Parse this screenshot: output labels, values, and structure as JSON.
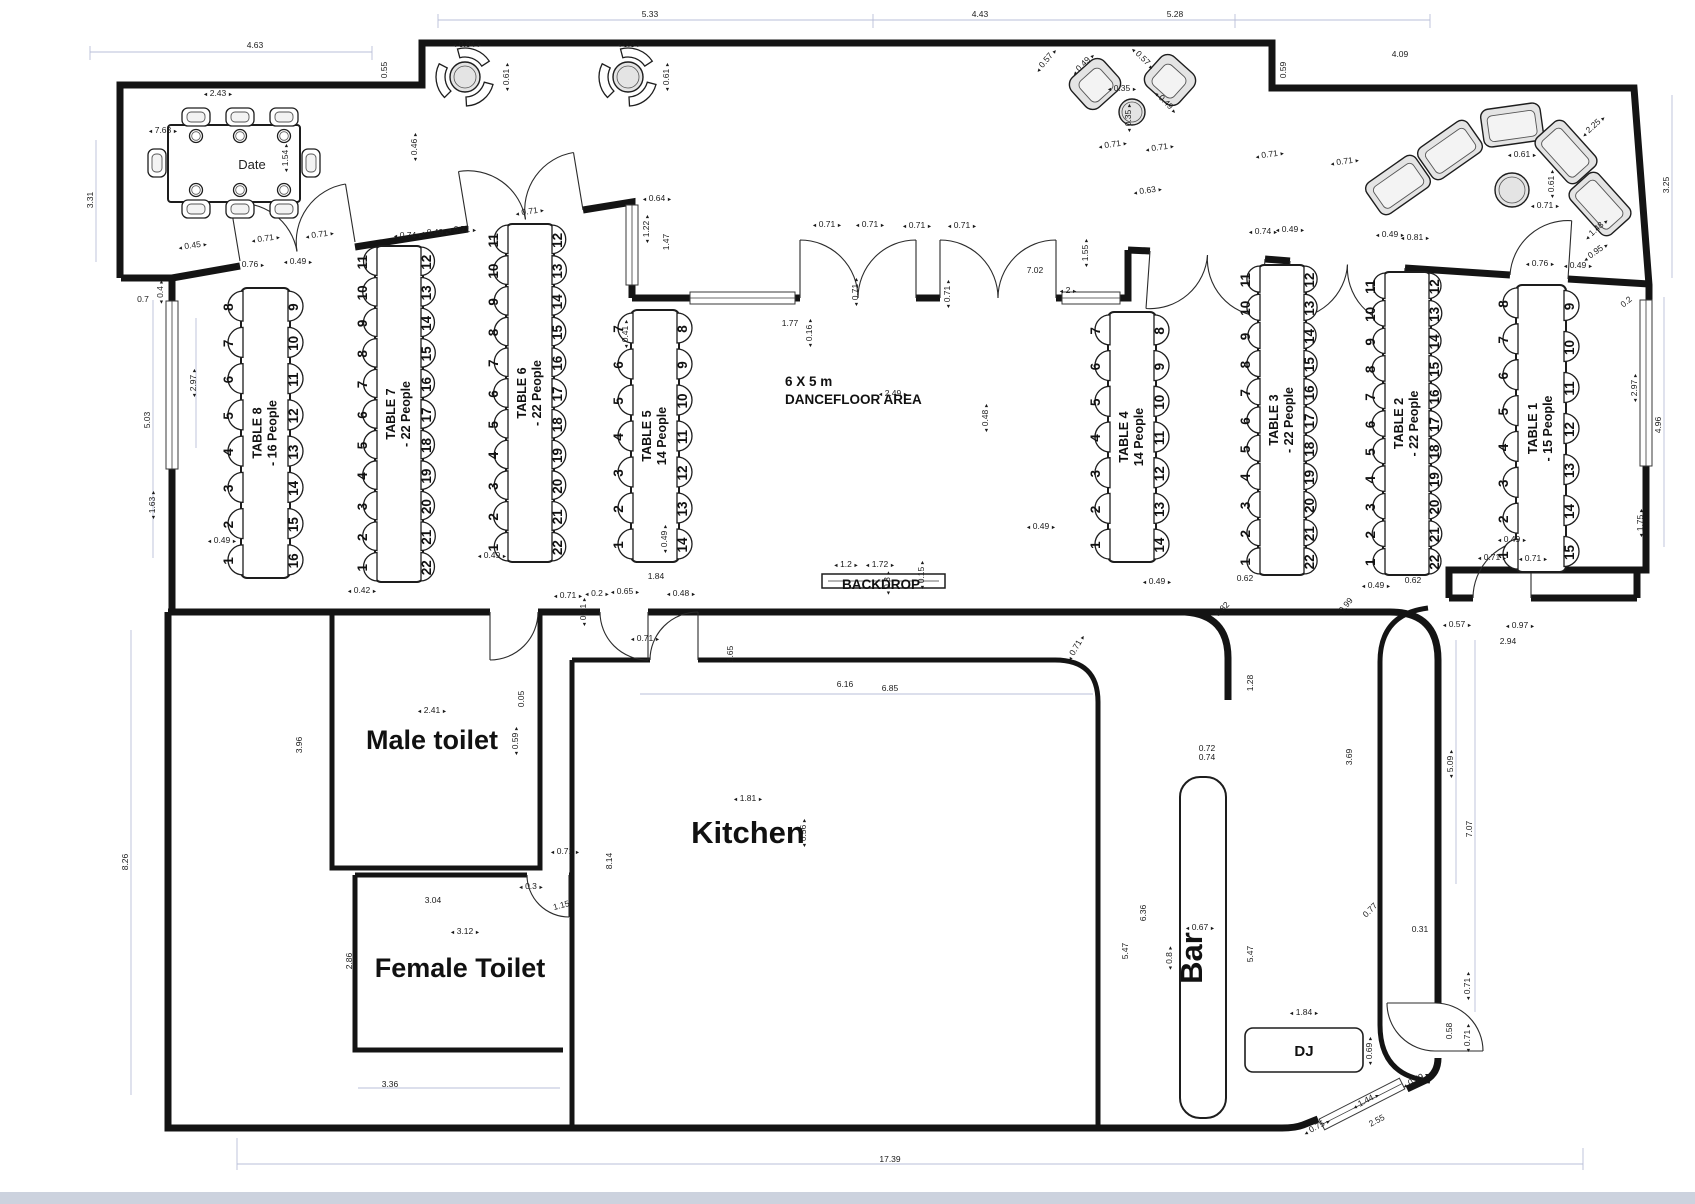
{
  "rooms": {
    "male_toilet": "Male toilet",
    "female_toilet": "Female Toilet",
    "kitchen": "Kitchen",
    "bar": "Bar",
    "dj": "DJ",
    "dancefloor_size": "6 X 5 m",
    "dancefloor_name": "DANCEFLOOR AREA",
    "backdrop": "BACKDROP",
    "head_table": "Date"
  },
  "tables": [
    {
      "name": "TABLE 1",
      "people": "- 15 People",
      "x": 1516,
      "y": 285,
      "w": 50,
      "h": 287,
      "left": [
        8,
        7,
        6,
        5,
        4,
        3,
        2,
        1
      ],
      "right": [
        9,
        10,
        11,
        12,
        13,
        14,
        15
      ]
    },
    {
      "name": "TABLE 2",
      "people": "- 22 People",
      "x": 1383,
      "y": 272,
      "w": 48,
      "h": 303,
      "left": [
        11,
        10,
        9,
        8,
        7,
        6,
        5,
        4,
        3,
        2,
        1
      ],
      "right": [
        12,
        13,
        14,
        15,
        16,
        17,
        18,
        19,
        20,
        21,
        22
      ]
    },
    {
      "name": "TABLE 3",
      "people": "- 22 People",
      "x": 1258,
      "y": 265,
      "w": 48,
      "h": 310,
      "left": [
        11,
        10,
        9,
        8,
        7,
        6,
        5,
        4,
        3,
        2,
        1
      ],
      "right": [
        12,
        13,
        14,
        15,
        16,
        17,
        18,
        19,
        20,
        21,
        22
      ]
    },
    {
      "name": "TABLE 4",
      "people": "14 People",
      "x": 1108,
      "y": 312,
      "w": 48,
      "h": 250,
      "left": [
        7,
        6,
        5,
        4,
        3,
        2,
        1
      ],
      "right": [
        8,
        9,
        10,
        11,
        12,
        13,
        14
      ]
    },
    {
      "name": "TABLE 5",
      "people": "14 People",
      "x": 631,
      "y": 310,
      "w": 48,
      "h": 252,
      "left": [
        7,
        6,
        5,
        4,
        3,
        2,
        1
      ],
      "right": [
        8,
        9,
        10,
        11,
        12,
        13,
        14
      ]
    },
    {
      "name": "TABLE 6",
      "people": "- 22 People",
      "x": 506,
      "y": 224,
      "w": 48,
      "h": 338,
      "left": [
        11,
        10,
        9,
        8,
        7,
        6,
        5,
        4,
        3,
        2,
        1
      ],
      "right": [
        12,
        13,
        14,
        15,
        16,
        17,
        18,
        19,
        20,
        21,
        22
      ]
    },
    {
      "name": "TABLE 7",
      "people": "- 22 People",
      "x": 375,
      "y": 246,
      "w": 48,
      "h": 336,
      "left": [
        11,
        10,
        9,
        8,
        7,
        6,
        5,
        4,
        3,
        2,
        1
      ],
      "right": [
        12,
        13,
        14,
        15,
        16,
        17,
        18,
        19,
        20,
        21,
        22
      ]
    },
    {
      "name": "TABLE 8",
      "people": "- 16 People",
      "x": 241,
      "y": 288,
      "w": 49,
      "h": 290,
      "left": [
        8,
        7,
        6,
        5,
        4,
        3,
        2,
        1
      ],
      "right": [
        9,
        10,
        11,
        12,
        13,
        14,
        15,
        16
      ]
    }
  ],
  "dims": [
    [
      "5.33",
      650,
      17,
      0,
      0
    ],
    [
      "4.43",
      980,
      17,
      0,
      0
    ],
    [
      "5.28",
      1175,
      17,
      0,
      0
    ],
    [
      "4.63",
      255,
      48,
      0,
      0
    ],
    [
      "0.55",
      387,
      70,
      -90,
      0
    ],
    [
      "0.84",
      467,
      47,
      0,
      1
    ],
    [
      "0.61",
      509,
      77,
      -90,
      1
    ],
    [
      "0.8",
      629,
      47,
      0,
      1
    ],
    [
      "0.61",
      669,
      77,
      -90,
      1
    ],
    [
      "0.57",
      1048,
      62,
      -50,
      1
    ],
    [
      "0.49",
      1085,
      66,
      -45,
      1
    ],
    [
      "0.35",
      1122,
      91,
      0,
      1
    ],
    [
      "0.35",
      1131,
      118,
      -90,
      1
    ],
    [
      "0.57",
      1141,
      60,
      45,
      1
    ],
    [
      "0.49",
      1164,
      104,
      45,
      1
    ],
    [
      "4.09",
      1400,
      57,
      0,
      0
    ],
    [
      "0.59",
      1286,
      70,
      -90,
      0
    ],
    [
      "2.25",
      1595,
      128,
      -42,
      1
    ],
    [
      "0.61",
      1522,
      157,
      0,
      1
    ],
    [
      "0.61",
      1554,
      184,
      -90,
      1
    ],
    [
      "0.71",
      1545,
      208,
      0,
      1
    ],
    [
      "1.48",
      1598,
      231,
      -42,
      1
    ],
    [
      "0.95",
      1597,
      254,
      -35,
      1
    ],
    [
      "3.25",
      1669,
      185,
      -90,
      0
    ],
    [
      "0.2",
      1628,
      304,
      -40,
      0
    ],
    [
      "2.97",
      1637,
      388,
      -90,
      1
    ],
    [
      "4.96",
      1661,
      425,
      -90,
      0
    ],
    [
      "1.75",
      1643,
      523,
      -90,
      1
    ],
    [
      "3.31",
      93,
      200,
      -90,
      0
    ],
    [
      "7.63",
      163,
      133,
      0,
      1
    ],
    [
      "2.43",
      218,
      96,
      0,
      1
    ],
    [
      "1.54",
      288,
      158,
      -90,
      1
    ],
    [
      "0.46",
      417,
      147,
      -90,
      1
    ],
    [
      "0.4",
      163,
      292,
      -90,
      1
    ],
    [
      "0.7",
      143,
      302,
      0,
      0
    ],
    [
      "5.03",
      150,
      420,
      -90,
      0
    ],
    [
      "2.97",
      196,
      383,
      -90,
      1
    ],
    [
      "1.63",
      155,
      505,
      -90,
      1
    ],
    [
      "8.26",
      128,
      862,
      -90,
      0
    ],
    [
      "0.45",
      193,
      248,
      -8,
      1
    ],
    [
      "0.71",
      266,
      241,
      -8,
      1
    ],
    [
      "0.71",
      320,
      237,
      -8,
      1
    ],
    [
      "0.76",
      250,
      267,
      0,
      1
    ],
    [
      "0.49",
      298,
      264,
      0,
      1
    ],
    [
      "0.74",
      408,
      238,
      0,
      1
    ],
    [
      "0.49",
      435,
      235,
      0,
      1
    ],
    [
      "0.71",
      462,
      232,
      0,
      1
    ],
    [
      "0.71",
      530,
      214,
      -8,
      1
    ],
    [
      "0.64",
      657,
      201,
      0,
      1
    ],
    [
      "1.22",
      649,
      229,
      -90,
      1
    ],
    [
      "1.47",
      669,
      242,
      -90,
      0
    ],
    [
      "0.41",
      628,
      334,
      -90,
      1
    ],
    [
      "1.77",
      790,
      326,
      0,
      0
    ],
    [
      "0.16",
      812,
      333,
      -90,
      1
    ],
    [
      "0.71",
      827,
      227,
      0,
      1
    ],
    [
      "0.71",
      870,
      227,
      0,
      1
    ],
    [
      "0.71",
      917,
      228,
      0,
      1
    ],
    [
      "0.71",
      962,
      228,
      0,
      1
    ],
    [
      "0.71",
      858,
      292,
      -90,
      1
    ],
    [
      "0.71",
      950,
      294,
      -90,
      1
    ],
    [
      "7.02",
      1035,
      273,
      0,
      0
    ],
    [
      "2",
      1068,
      293,
      0,
      1
    ],
    [
      "1.55",
      1088,
      253,
      -90,
      1
    ],
    [
      "0.63",
      1148,
      193,
      -8,
      1
    ],
    [
      "0.71",
      1113,
      147,
      -8,
      1
    ],
    [
      "0.71",
      1160,
      150,
      -8,
      1
    ],
    [
      "0.71",
      1270,
      157,
      -8,
      1
    ],
    [
      "0.71",
      1345,
      164,
      -8,
      1
    ],
    [
      "0.74",
      1263,
      234,
      0,
      1
    ],
    [
      "0.49",
      1290,
      232,
      0,
      1
    ],
    [
      "0.49",
      1390,
      237,
      0,
      1
    ],
    [
      "0.81",
      1415,
      240,
      0,
      1
    ],
    [
      "0.76",
      1540,
      266,
      0,
      1
    ],
    [
      "0.49",
      1578,
      268,
      0,
      1
    ],
    [
      "2.49",
      893,
      396,
      0,
      1
    ],
    [
      "0.48",
      988,
      418,
      -90,
      1
    ],
    [
      "1.2",
      846,
      567,
      0,
      1
    ],
    [
      "1.72",
      880,
      567,
      0,
      1
    ],
    [
      "0.15",
      924,
      575,
      -90,
      1
    ],
    [
      "0.3",
      890,
      583,
      -90,
      1
    ],
    [
      "0.49",
      222,
      543,
      0,
      1
    ],
    [
      "0.42",
      362,
      593,
      0,
      1
    ],
    [
      "1.84",
      656,
      579,
      0,
      0
    ],
    [
      "0.49",
      492,
      558,
      0,
      1
    ],
    [
      "0.49",
      667,
      539,
      -90,
      1
    ],
    [
      "0.71",
      568,
      598,
      0,
      1
    ],
    [
      "0.2",
      597,
      596,
      0,
      1
    ],
    [
      "0.65",
      625,
      594,
      0,
      1
    ],
    [
      "0.48",
      681,
      596,
      0,
      1
    ],
    [
      "0.71",
      586,
      612,
      -90,
      1
    ],
    [
      "0.49",
      1041,
      529,
      0,
      1
    ],
    [
      "0.49",
      1157,
      584,
      0,
      1
    ],
    [
      "0.62",
      1245,
      581,
      0,
      0
    ],
    [
      "0.49",
      1376,
      588,
      0,
      1
    ],
    [
      "0.62",
      1413,
      583,
      0,
      0
    ],
    [
      "0.49",
      1512,
      542,
      0,
      1
    ],
    [
      "0.71",
      1492,
      560,
      0,
      1
    ],
    [
      "0.71",
      1533,
      561,
      0,
      1
    ],
    [
      "2.41",
      432,
      713,
      0,
      1
    ],
    [
      "0.59",
      518,
      741,
      -90,
      1
    ],
    [
      "0.05",
      524,
      699,
      -90,
      0
    ],
    [
      "3.96",
      302,
      745,
      -90,
      0
    ],
    [
      "3.04",
      433,
      903,
      0,
      0
    ],
    [
      "0.3",
      531,
      889,
      0,
      1
    ],
    [
      "1.15",
      562,
      908,
      -15,
      0
    ],
    [
      "3.12",
      465,
      934,
      0,
      1
    ],
    [
      "2.86",
      352,
      961,
      -90,
      0
    ],
    [
      "3.36",
      390,
      1087,
      0,
      0
    ],
    [
      "0.71",
      565,
      854,
      0,
      1
    ],
    [
      "0.71",
      645,
      641,
      0,
      1
    ],
    [
      "1.81",
      748,
      801,
      0,
      1
    ],
    [
      "0.56",
      806,
      833,
      -90,
      1
    ],
    [
      "8.14",
      612,
      861,
      -90,
      0
    ],
    [
      "1.65",
      733,
      654,
      -90,
      0
    ],
    [
      "6.16",
      845,
      687,
      0,
      0
    ],
    [
      "6.85",
      890,
      691,
      0,
      0
    ],
    [
      "0.71",
      1078,
      649,
      -60,
      1
    ],
    [
      "0.82",
      1224,
      611,
      -45,
      0
    ],
    [
      "0.99",
      1348,
      607,
      -50,
      0
    ],
    [
      "1.28",
      1253,
      683,
      -90,
      0
    ],
    [
      "0.72",
      1207,
      751,
      0,
      0
    ],
    [
      "0.74",
      1207,
      760,
      0,
      0
    ],
    [
      "6.36",
      1146,
      913,
      -90,
      0
    ],
    [
      "5.47",
      1128,
      951,
      -90,
      0
    ],
    [
      "0.8",
      1172,
      958,
      -90,
      1
    ],
    [
      "0.67",
      1200,
      930,
      0,
      1
    ],
    [
      "5.47",
      1253,
      954,
      -90,
      0
    ],
    [
      "3.69",
      1352,
      757,
      -90,
      0
    ],
    [
      "0.77",
      1372,
      912,
      -45,
      0
    ],
    [
      "0.31",
      1420,
      932,
      0,
      0
    ],
    [
      "5.09",
      1453,
      764,
      -90,
      1
    ],
    [
      "7.07",
      1472,
      829,
      -90,
      0
    ],
    [
      "0.57",
      1457,
      627,
      0,
      1
    ],
    [
      "0.97",
      1520,
      628,
      0,
      1
    ],
    [
      "2.94",
      1508,
      644,
      0,
      0
    ],
    [
      "1.84",
      1304,
      1015,
      0,
      1
    ],
    [
      "0.69",
      1372,
      1051,
      -90,
      1
    ],
    [
      "0.58",
      1452,
      1031,
      -90,
      0
    ],
    [
      "0.71",
      1470,
      986,
      -90,
      1
    ],
    [
      "0.71",
      1470,
      1038,
      -90,
      1
    ],
    [
      "0.75",
      1318,
      1129,
      -28,
      1
    ],
    [
      "1.44",
      1367,
      1103,
      -28,
      1
    ],
    [
      "2.55",
      1378,
      1123,
      -28,
      0
    ],
    [
      "0.79",
      1417,
      1082,
      -28,
      1
    ],
    [
      "17.39",
      890,
      1162,
      0,
      0
    ]
  ],
  "colors": {
    "wall": "#141414",
    "dim_text": "#1b1b1b",
    "guide": "#b9bfd8"
  }
}
